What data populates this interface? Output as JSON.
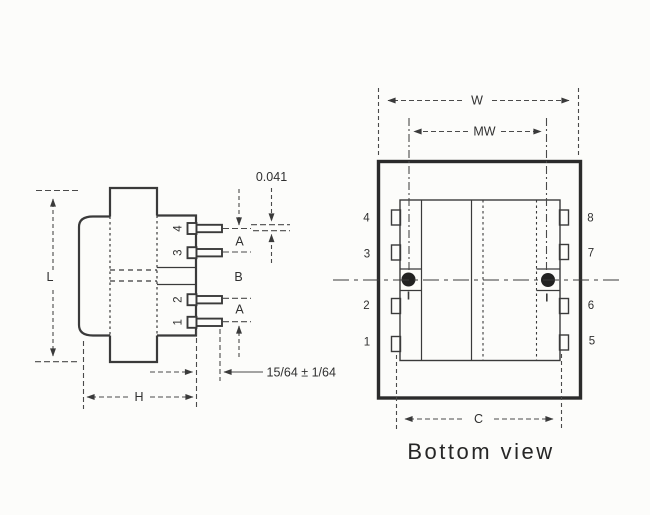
{
  "figure": {
    "type": "technical-drawing",
    "views": [
      "side view",
      "bottom view"
    ],
    "side_view": {
      "pin_labels_top_to_bottom": [
        "4",
        "3",
        "2",
        "1"
      ],
      "dimensions": {
        "length": "L",
        "height": "H",
        "pin_pitch_top": "A",
        "pin_pitch_middle": "B",
        "pin_pitch_bottom": "A",
        "pin_thickness": "0.041",
        "pin_length": "15/64 ± 1/64"
      }
    },
    "bottom_view": {
      "caption": "Bottom view",
      "left_pin_labels_top_to_bottom": [
        "4",
        "3",
        "2",
        "1"
      ],
      "right_pin_labels_top_to_bottom": [
        "8",
        "7",
        "6",
        "5"
      ],
      "dimensions": {
        "overall_width": "W",
        "mounting_width": "MW",
        "pin_row_spacing": "C"
      }
    },
    "colors": {
      "ink": "#3a3a3a",
      "heavy_ink": "#2b2b2b",
      "paper": "#fcfcfa"
    }
  }
}
